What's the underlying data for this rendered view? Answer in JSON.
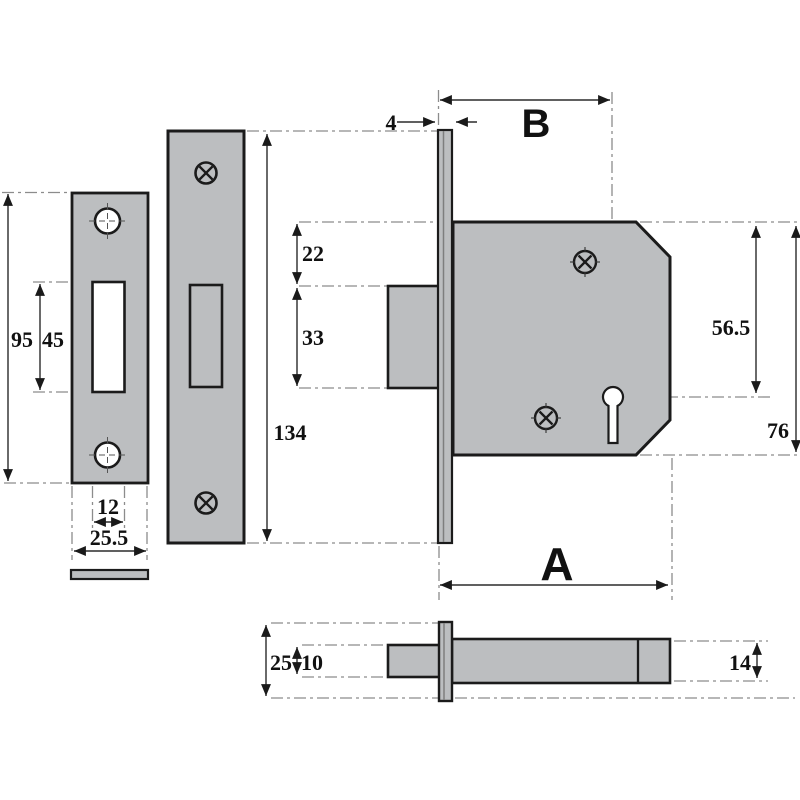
{
  "diagram": {
    "subject": "Mortice deadlock technical dimension drawing with strike plate, faceplate, lock case side view and plan view",
    "background_color": "#ffffff",
    "part_fill_color": "#bcbec0",
    "outline_color": "#1b1b1b",
    "centerline_color": "#8c8c8c",
    "dimension_line_color": "#2b2b2b",
    "labels": {
      "strike_plate_height": "95",
      "strike_slot_height": "45",
      "strike_slot_width": "12",
      "strike_plate_width": "25.5",
      "faceplate_height": "134",
      "faceplate_thickness": "4",
      "backset": "B",
      "bolt_top_offset": "22",
      "bolt_height": "33",
      "keyhole_centre_from_top": "56.5",
      "case_height": "76",
      "case_depth": "A",
      "plan_faceplate_width": "25",
      "plan_bolt_thickness": "10",
      "plan_case_thickness": "14"
    }
  }
}
